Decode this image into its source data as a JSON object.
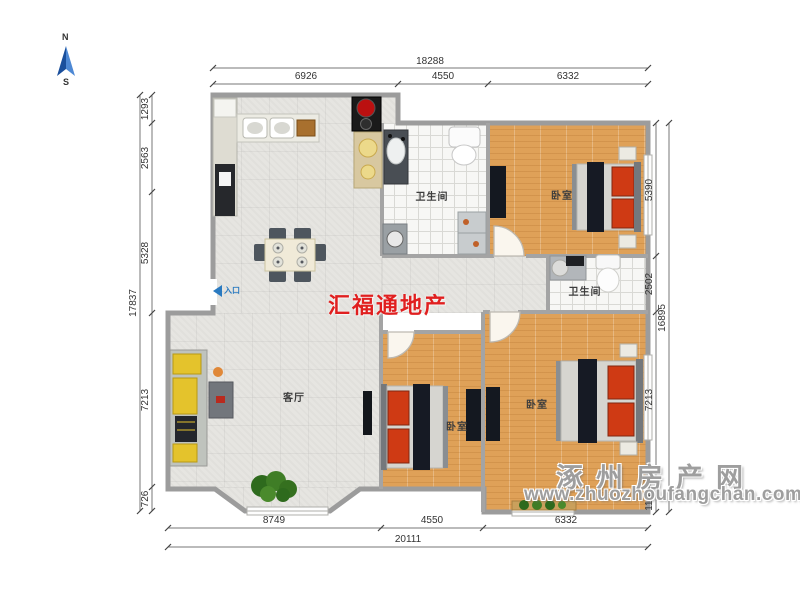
{
  "compass": {
    "n": "N",
    "s": "S"
  },
  "entrance": {
    "label": "入口"
  },
  "watermarks": {
    "brand": "汇福通地产",
    "site": "涿州房产网",
    "url": "www.zhuozhoufangchan.com"
  },
  "rooms": {
    "bathroom_top": "卫生间",
    "bedroom_top": "卧室",
    "bathroom_mid": "卫生间",
    "bedroom_right": "卧室",
    "bedroom_mid": "卧室",
    "living": "客厅"
  },
  "dims": {
    "top": {
      "overall": "18288",
      "seg1": "6926",
      "seg2": "4550",
      "seg3": "6332"
    },
    "bottom": {
      "overall": "20111",
      "seg1": "8749",
      "seg2": "4550",
      "seg3": "6332"
    },
    "left": {
      "overall": "17837",
      "seg1": "1293",
      "seg2": "2563",
      "seg3": "5328",
      "seg4": "7213",
      "seg5": "726"
    },
    "right": {
      "overall": "16895",
      "seg1": "5390",
      "seg2": "2502",
      "seg3": "7213",
      "seg4": "1155"
    }
  },
  "colors": {
    "brand_red": "#e01f1f",
    "watermark_grey": "#9e9e9e",
    "compass_blue": "#2f6fc4",
    "entrance_blue": "#2a7ac0",
    "wall_grey": "#9c9c9c",
    "wood_floor": "#dfa158",
    "bed_red": "#cf3a14"
  }
}
